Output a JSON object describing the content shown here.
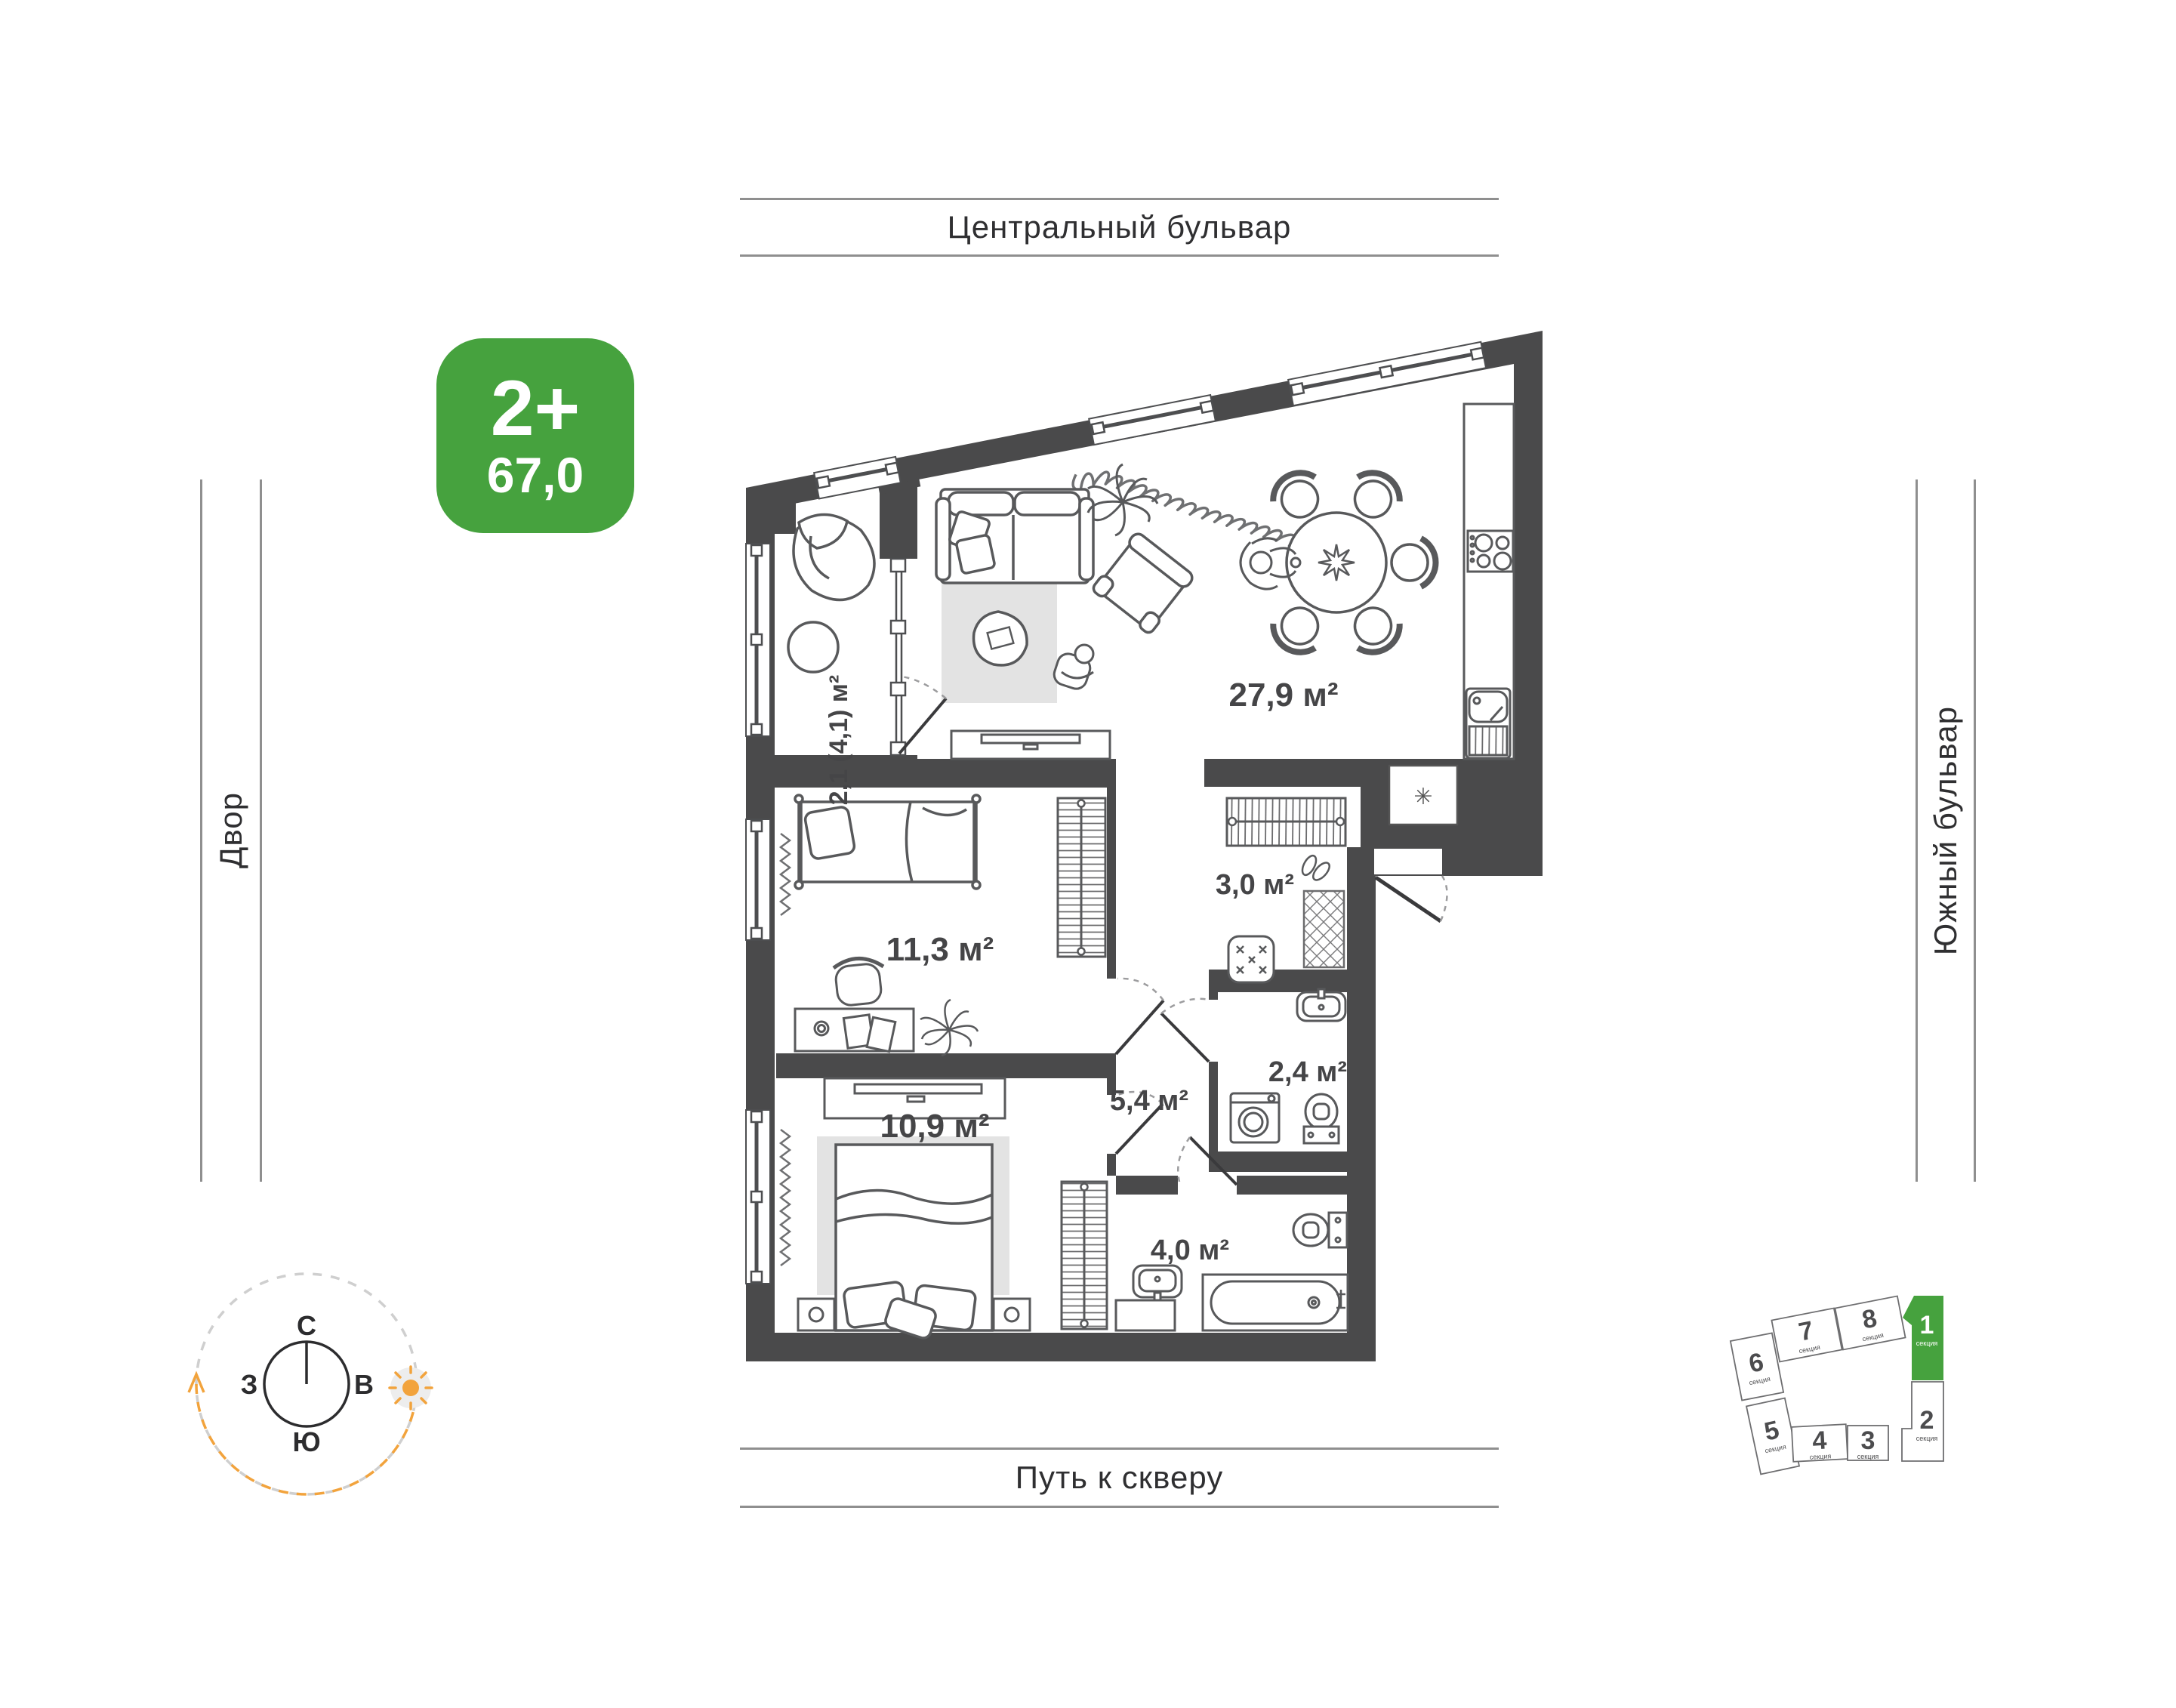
{
  "streets": {
    "top": "Центральный бульвар",
    "bottom": "Путь к скверу",
    "left": "Двор",
    "right": "Южный бульвар"
  },
  "badge": {
    "rooms_label": "2+",
    "area_value": "67,0"
  },
  "rooms": [
    {
      "name": "balcony",
      "area": "2,1 (4,1) м²"
    },
    {
      "name": "kitchen_living",
      "area": "27,9 м²"
    },
    {
      "name": "entry_hall",
      "area": "3,0 м²"
    },
    {
      "name": "bedroom_1",
      "area": "11,3 м²"
    },
    {
      "name": "corridor",
      "area": "5,4 м²"
    },
    {
      "name": "bathroom_small",
      "area": "2,4 м²"
    },
    {
      "name": "bedroom_2",
      "area": "10,9 м²"
    },
    {
      "name": "bathroom_large",
      "area": "4,0 м²"
    }
  ],
  "compass": {
    "north": "С",
    "east": "В",
    "south": "Ю",
    "west": "З"
  },
  "building_map": {
    "section_label": "секция",
    "active_section": "1",
    "sections": [
      "1",
      "2",
      "3",
      "4",
      "5",
      "6",
      "7",
      "8"
    ]
  },
  "plan_symbols": {
    "utility": "✳"
  },
  "colors": {
    "accent_green": "#46a23e",
    "wall": "#4a4a4b",
    "furniture_line": "#58595b",
    "sun_orange": "#f2a33c"
  }
}
